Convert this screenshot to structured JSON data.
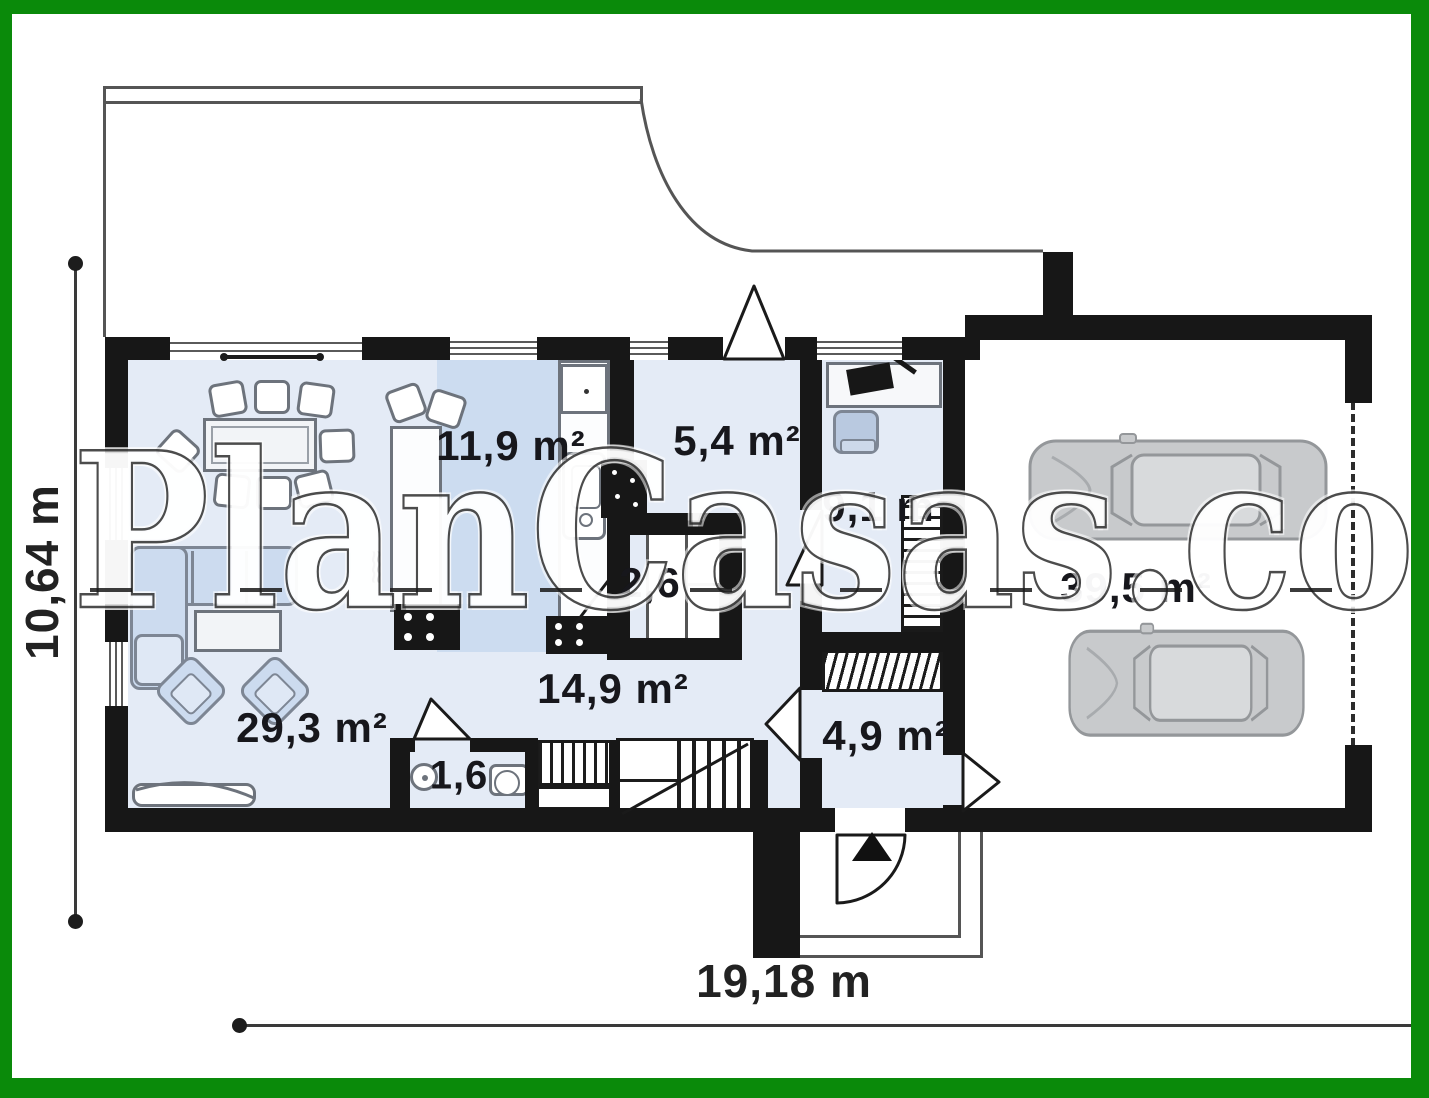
{
  "plan": {
    "watermark": "PlanCasas.com",
    "dimensions": {
      "height_label": "10,64 m",
      "width_label": "19,18 m"
    },
    "rooms": [
      {
        "id": "living-room",
        "area_label": "29,3 m²"
      },
      {
        "id": "kitchen",
        "area_label": "11,9 m²"
      },
      {
        "id": "corridor",
        "area_label": "5,4 m²"
      },
      {
        "id": "office",
        "area_label": "9,1 m²"
      },
      {
        "id": "pantry",
        "area_label": "2,6"
      },
      {
        "id": "hall",
        "area_label": "14,9 m²"
      },
      {
        "id": "wc",
        "area_label": "1,6"
      },
      {
        "id": "entry",
        "area_label": "4,9 m²"
      },
      {
        "id": "garage",
        "area_label": "39,5 m²"
      }
    ],
    "icons": {
      "entrance-arrow": "triangle-up",
      "cars": "two cars top view"
    },
    "colors": {
      "frame_green": "#0a8a0a",
      "wall_black": "#171717",
      "floor_light_blue": "#e4ebf6",
      "kitchen_floor_blue": "#ccdcf0",
      "furniture_blue": "#ccdbef",
      "car_gray": "#c8cacc"
    }
  }
}
